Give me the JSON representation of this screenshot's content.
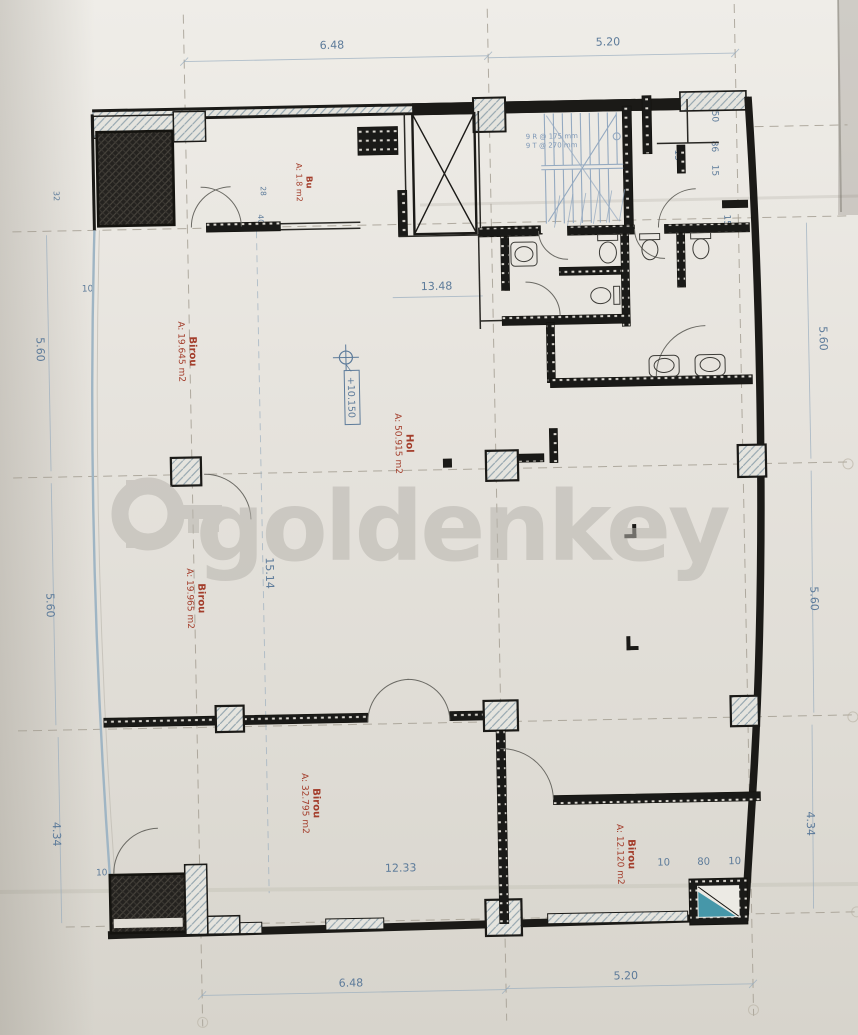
{
  "sheet": {
    "watermark": "goldenkey",
    "level_marker": "+10.150"
  },
  "rooms": [
    {
      "name": "Bu",
      "area": "A: 1.8 m2"
    },
    {
      "name": "Birou",
      "area": "A: 19.645 m2"
    },
    {
      "name": "Hol",
      "area": "A: 50.915 m2"
    },
    {
      "name": "Birou",
      "area": "A: 19.965 m2"
    },
    {
      "name": "Birou",
      "area": "A: 32.795 m2"
    },
    {
      "name": "Birou",
      "area": "A: 12.120 m2"
    }
  ],
  "dimensions": {
    "top": [
      "6.48",
      "5.20"
    ],
    "bottom": [
      "6.48",
      "5.20"
    ],
    "left": [
      "5.60",
      "5.60",
      "4.34"
    ],
    "right": [
      "5.60",
      "5.60",
      "4.34"
    ],
    "interior_width_upper": "13.48",
    "interior_height": "15.14",
    "interior_width_lower": "12.33",
    "shaft_triplet": [
      "10",
      "80",
      "10"
    ],
    "offset_left_upper": "10",
    "offset_left_lower": "10",
    "small_marks": [
      "32",
      "28",
      "40"
    ],
    "stair_chain": [
      "50",
      "86",
      "15"
    ],
    "stair_wall_a": "15",
    "stair_wall_b": "15"
  },
  "stairs": {
    "risers": "9 R @ 175 mm",
    "treads": "9 T @ 270 mm"
  },
  "colors": {
    "paper": "#e6e3dd",
    "ink": "#1b1a17",
    "dim_blue": "#5d7b9a",
    "label_red": "#a33d2b",
    "stair_blue": "#8ba3bd",
    "watermark_gray": "#c6c3bd",
    "shaft_teal": "#2f8ba0"
  }
}
